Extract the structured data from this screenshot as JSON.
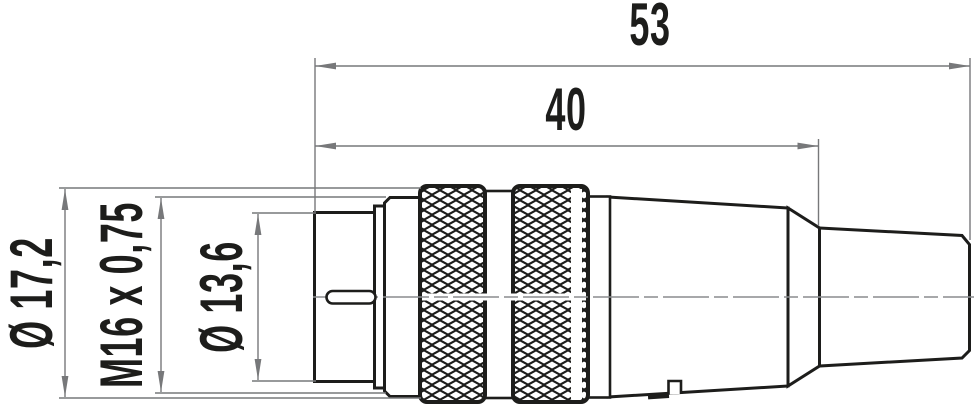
{
  "drawing": {
    "type": "technical-dimension-drawing",
    "background_color": "#ffffff",
    "outline_color": "#1d1d1b",
    "thin_line_color": "#77787a",
    "text_color": "#1d1d1b",
    "dimensions": {
      "overall_length": "53",
      "front_length": "40",
      "outer_diameter": "Ø 17,2",
      "thread": "M16 x 0,75",
      "mating_diameter": "Ø 13,6"
    }
  }
}
